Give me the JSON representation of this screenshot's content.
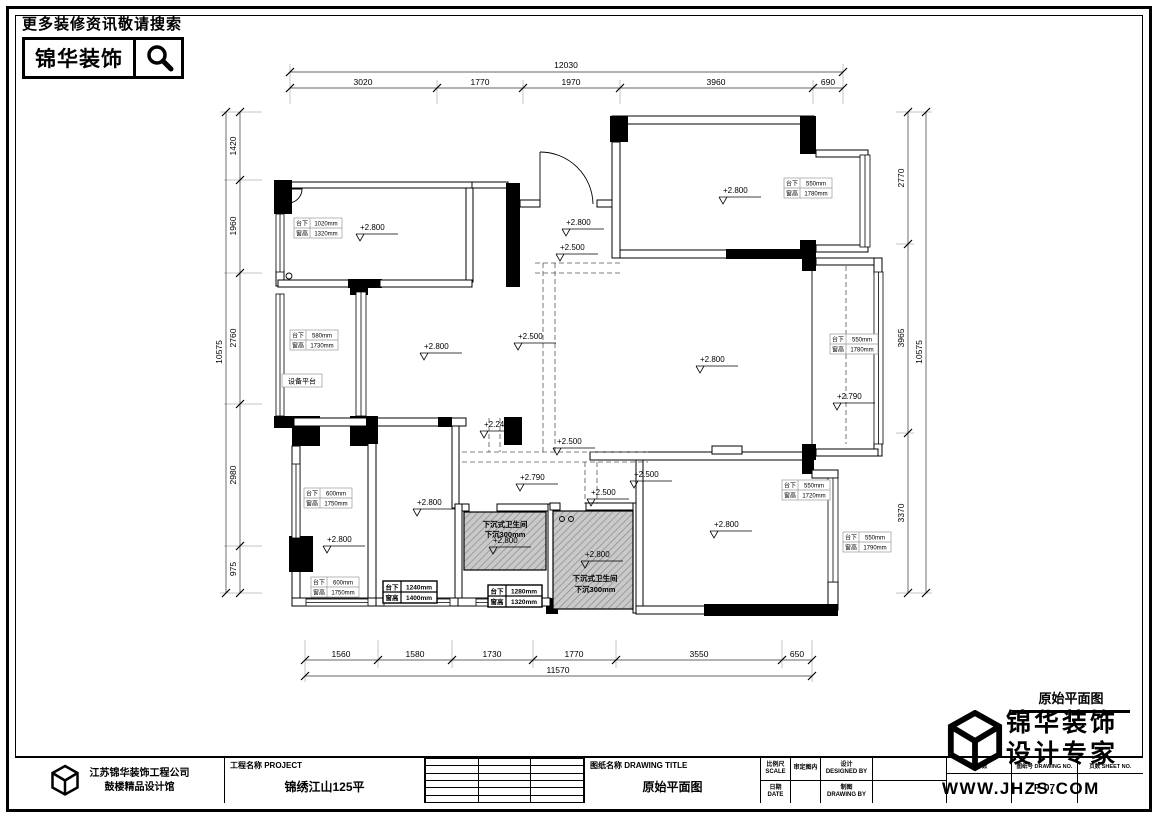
{
  "header": {
    "search_note": "更多装修资讯敬请搜索",
    "brand": "锦华装饰"
  },
  "dims": {
    "top": {
      "total": "12030",
      "segs": [
        "3020",
        "1770",
        "1970",
        "3960",
        "690"
      ]
    },
    "bottom": {
      "total": "11570",
      "segs": [
        "1560",
        "1580",
        "1730",
        "1770",
        "3550",
        "650"
      ]
    },
    "left": {
      "total": "10575",
      "segs": [
        "1420",
        "1960",
        "2760",
        "2980",
        "975"
      ]
    },
    "right": {
      "total": "10575",
      "segs": [
        "2770",
        "3965",
        "3370"
      ]
    }
  },
  "levels": [
    "+2.800",
    "+2.800",
    "+2.500",
    "+2.800",
    "+2.800",
    "+2.500",
    "+2.800",
    "+2.790",
    "+2.240",
    "+2.500",
    "+2.790",
    "+2.500",
    "+2.500",
    "+2.800",
    "+2.800",
    "+2.800",
    "+2.800",
    "+2.800"
  ],
  "win_labels": [
    {
      "k1": "台下",
      "v1": "1020mm",
      "k2": "窗高",
      "v2": "1320mm"
    },
    {
      "k1": "台下",
      "v1": "580mm",
      "k2": "窗高",
      "v2": "1730mm"
    },
    {
      "k1": "台下",
      "v1": "550mm",
      "k2": "窗高",
      "v2": "1780mm"
    },
    {
      "k1": "台下",
      "v1": "550mm",
      "k2": "窗高",
      "v2": "1780mm"
    },
    {
      "k1": "台下",
      "v1": "600mm",
      "k2": "窗高",
      "v2": "1750mm"
    },
    {
      "k1": "台下",
      "v1": "600mm",
      "k2": "窗高",
      "v2": "1750mm"
    },
    {
      "k1": "台下",
      "v1": "1240mm",
      "k2": "窗高",
      "v2": "1400mm"
    },
    {
      "k1": "台下",
      "v1": "1280mm",
      "k2": "窗高",
      "v2": "1320mm"
    },
    {
      "k1": "台下",
      "v1": "550mm",
      "k2": "窗高",
      "v2": "1720mm"
    },
    {
      "k1": "台下",
      "v1": "550mm",
      "k2": "窗高",
      "v2": "1790mm"
    }
  ],
  "annotations": {
    "equipment": "设备平台",
    "sunken1a": "下沉式卫生间",
    "sunken1b": "下沉300mm",
    "sunken2a": "下沉式卫生间",
    "sunken2b": "下沉300mm"
  },
  "titleblock": {
    "company_line1": "江苏锦华装饰工程公司",
    "company_line2": "鼓楼精品设计馆",
    "project_label": "工程名称 PROJECT",
    "project_value": "锦绣江山125平",
    "drawing_label": "图纸名称 DRAWING TITLE",
    "drawing_value": "原始平面图",
    "scale_cn": "比例尺",
    "scale_en": "SCALE",
    "review": "审定图内",
    "designed_cn": "设计",
    "designed_en": "DESIGNED BY",
    "date_cn": "日期",
    "date_en": "DATE",
    "drawn_cn": "制图",
    "drawn_en": "DRAWING BY",
    "area_label": "平方数",
    "drawing_no_label": "图纸号 DRAWING NO.",
    "sheet_no_label": "页数 SHEET NO.",
    "drawing_no_value": "P-07"
  },
  "corner": {
    "title": "原始平面图",
    "brand_line1": "锦华装饰",
    "brand_line2": "设计专家",
    "url": "WWW.JHZS.COM"
  }
}
